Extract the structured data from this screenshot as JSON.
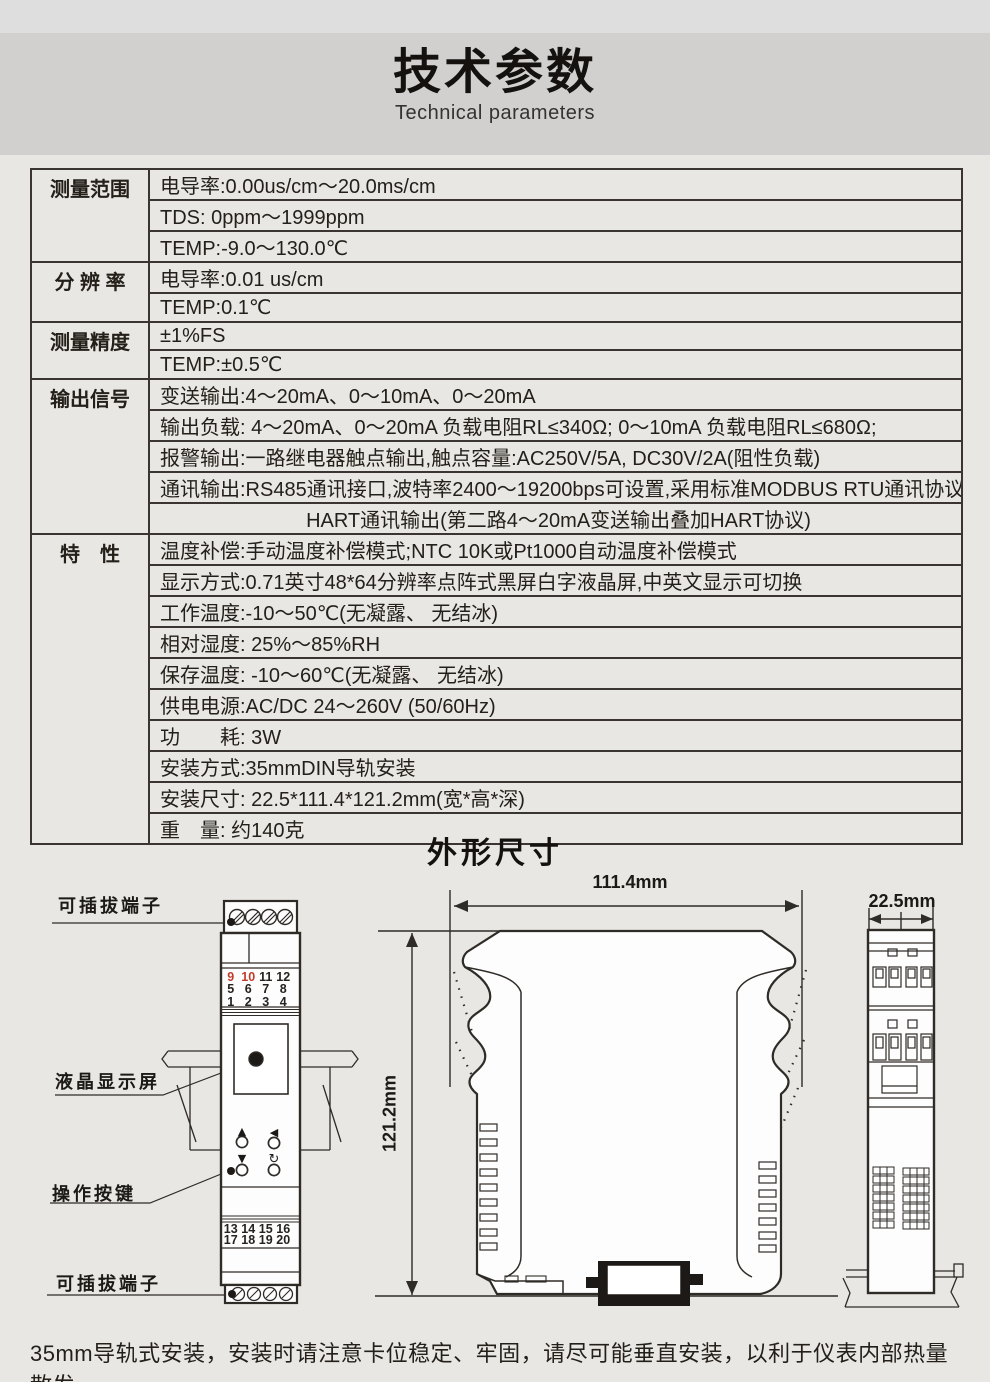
{
  "header": {
    "title": "技术参数",
    "subtitle": "Technical parameters"
  },
  "spec_table": {
    "groups": [
      {
        "label": "测量范围",
        "rows": [
          "电导率:0.00us/cm～20.0ms/cm",
          "TDS:  0ppm～1999ppm",
          "TEMP:-9.0～130.0℃"
        ]
      },
      {
        "label": "分 辨 率",
        "rows": [
          "电导率:0.01 us/cm",
          "TEMP:0.1℃"
        ]
      },
      {
        "label": "测量精度",
        "rows": [
          "±1%FS",
          "TEMP:±0.5℃"
        ]
      },
      {
        "label": "输出信号",
        "rows": [
          "变送输出:4～20mA、0～10mA、0～20mA",
          "输出负载: 4～20mA、0～20mA 负载电阻RL≤340Ω;  0～10mA 负载电阻RL≤680Ω;",
          "报警输出:一路继电器触点输出,触点容量:AC250V/5A, DC30V/2A(阻性负载)",
          "通讯输出:RS485通讯接口,波特率2400～19200bps可设置,采用标准MODBUS RTU通讯协议",
          {
            "text": "HART通讯输出(第二路4～20mA变送输出叠加HART协议)",
            "align": "center"
          }
        ]
      },
      {
        "label": "特　性",
        "rows": [
          "温度补偿:手动温度补偿模式;NTC 10K或Pt1000自动温度补偿模式",
          "显示方式:0.71英寸48*64分辨率点阵式黑屏白字液晶屏,中英文显示可切换",
          "工作温度:-10～50℃(无凝露、 无结冰)",
          "相对湿度: 25%～85%RH",
          "保存温度: -10～60℃(无凝露、 无结冰)",
          "供电电源:AC/DC 24～260V (50/60Hz)",
          "功　　耗: 3W",
          "安装方式:35mmDIN导轨安装",
          "安装尺寸: 22.5*111.4*121.2mm(宽*高*深)",
          "重　量: 约140克"
        ]
      }
    ]
  },
  "dimensions": {
    "title": "外形尺寸",
    "width_label": "111.4mm",
    "height_label": "121.2mm",
    "depth_label": "22.5mm"
  },
  "front_view": {
    "labels": {
      "top_terminal": "可插拔端子",
      "lcd": "液晶显示屏",
      "buttons": "操作按键",
      "bottom_terminal": "可插拔端子"
    },
    "terminals_top": {
      "rows": [
        [
          "9",
          "10",
          "11",
          "12"
        ],
        [
          "5",
          "6",
          "7",
          "8"
        ],
        [
          "1",
          "2",
          "3",
          "4"
        ]
      ],
      "highlighted": [
        "9",
        "10"
      ]
    },
    "terminals_bottom": {
      "rows": [
        [
          "13",
          "14",
          "15",
          "16"
        ],
        [
          "17",
          "18",
          "19",
          "20"
        ]
      ]
    },
    "icons": {
      "up": "▲",
      "down": "▼",
      "left": "◀",
      "rotate": "↻"
    }
  },
  "footer": {
    "note": "35mm导轨式安装，安装时请注意卡位稳定、牢固，请尽可能垂直安装，以利于仪表内部热量散发。"
  },
  "colors": {
    "accent_red": "#c23c2a",
    "ink": "#2f2b27",
    "band": "#d1d0cf"
  }
}
